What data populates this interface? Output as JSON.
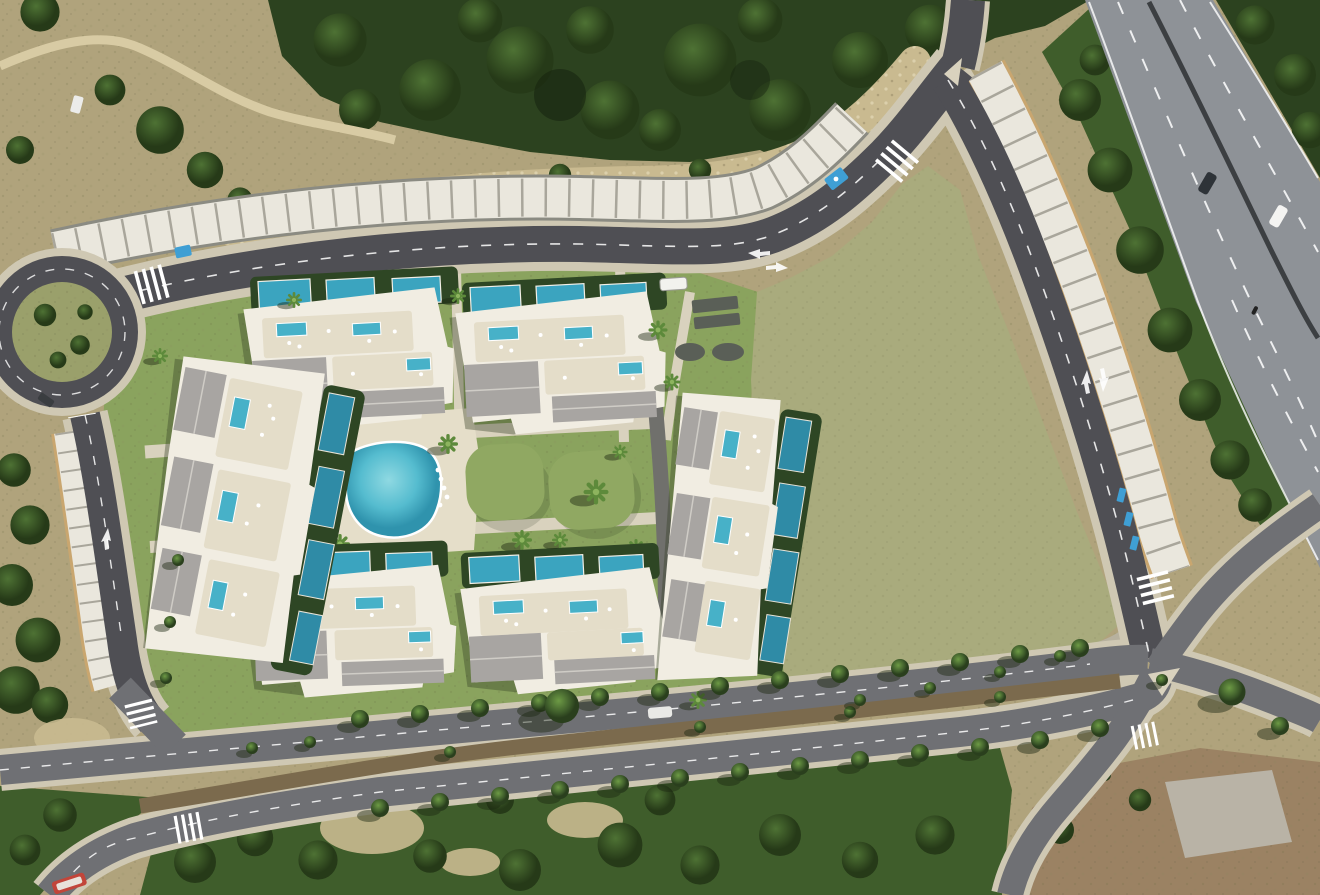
{
  "scene": {
    "type": "aerial-render-site-plan",
    "description": "aerial view of residential development with five apartment blocks, private and communal pools, landscaped amenity area, roundabout, perimeter roads with carports, large green field and adjacent highway",
    "building_block_count": 5,
    "communal_pool_count": 2,
    "roundabout_count": 1,
    "crosswalk_count": 7,
    "features": [
      {
        "name": "roundabout",
        "kind": "road"
      },
      {
        "name": "loop-road-north",
        "kind": "road"
      },
      {
        "name": "access-road-west",
        "kind": "road"
      },
      {
        "name": "service-road-east",
        "kind": "road"
      },
      {
        "name": "boulevard-south",
        "kind": "dual-carriageway"
      },
      {
        "name": "highway-northeast",
        "kind": "highway"
      },
      {
        "name": "green-field",
        "kind": "open-lot"
      },
      {
        "name": "forest-north",
        "kind": "vegetation"
      },
      {
        "name": "amenity-pool-area",
        "kind": "leisure"
      },
      {
        "name": "carport-canopies",
        "kind": "parking"
      }
    ],
    "vehicles": [
      {
        "name": "white-van-loop-road",
        "color": "#f2f2ee"
      },
      {
        "name": "dark-car-highway",
        "color": "#2e3338"
      },
      {
        "name": "white-car-highway",
        "color": "#f4f4f2"
      },
      {
        "name": "white-car-boulevard",
        "color": "#e9e9e6"
      },
      {
        "name": "bus-bottom-left",
        "color": "#c2453a"
      },
      {
        "name": "dark-car-roundabout",
        "color": "#3a3d40"
      },
      {
        "name": "parked-van-trail",
        "color": "#ececea"
      }
    ]
  },
  "palette": {
    "scrub_tan": "#b0a37c",
    "rock_light": "#c9ba90",
    "field_green": "#a9ab7d",
    "lawn_green": "#8aa35e",
    "mound_green": "#90a862",
    "path_cream": "#d9d2be",
    "deck_cream": "#e5dec9",
    "sidewalk": "#cfc8b3",
    "road_dark": "#4f4f54",
    "road_mid": "#6f7074",
    "highway_gray": "#8e9297",
    "median_brown": "#7b6a4d",
    "canopy_white": "#eae7dd",
    "canopy_line": "#98968b",
    "canopy_tan": "#c9a66f",
    "building_white": "#f1ede2",
    "terrace": "#e4ddc9",
    "roof_gray": "#a8a5a2",
    "pool_teal": "#47b1c8",
    "pool_mid": "#3ba4bf",
    "pool_dark": "#2f8ba6",
    "hedge": "#2e4624",
    "veg_dark": "#2c421f",
    "veg_mid": "#3f5d2b",
    "veg_light": "#587b36",
    "dirt_brown": "#9b8263",
    "pad_gray": "#b9b3a6",
    "dark_pad": "#5a5f57",
    "marking_blue": "#3f9fd4"
  }
}
